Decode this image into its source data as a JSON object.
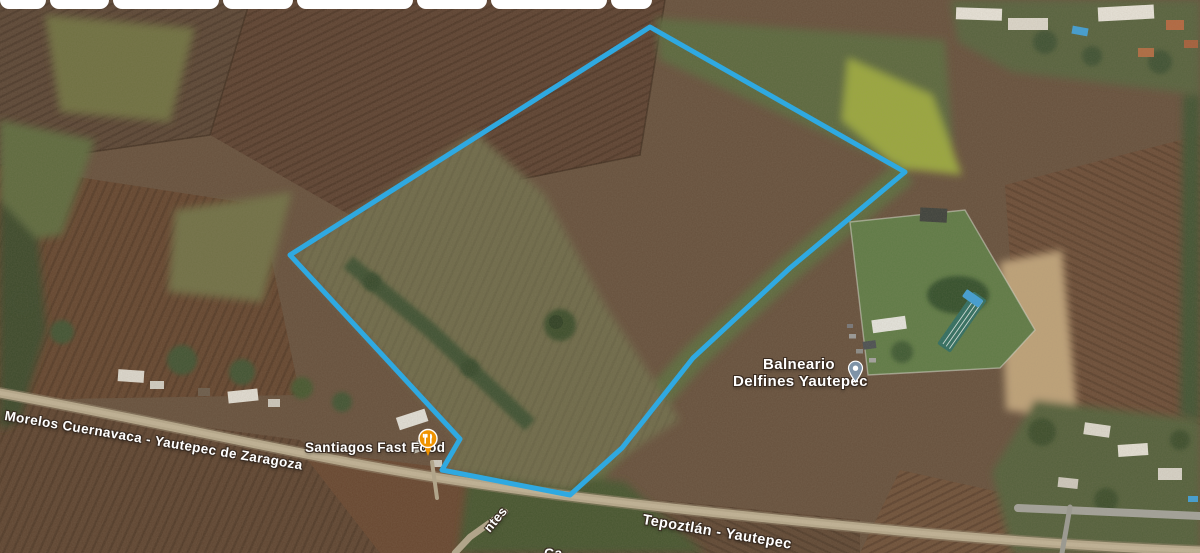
{
  "view": {
    "type": "satellite-map",
    "accent_color": "#2FA9E1"
  },
  "parcel_outline": {
    "color": "#2FA9E1",
    "stroke_width": 5,
    "points": "650,27 905,172 790,268 693,358 622,448 570,495 442,470 460,439 290,255"
  },
  "map_labels": {
    "road_primary": "Morelos Cuernavaca - Yautepec de Zaragoza",
    "road_secondary": "Tepoztlán - Yautepec",
    "street_fragment": "ntes",
    "partial_label_fragment": "Ca",
    "restaurant": {
      "name": "Santiagos Fast Food",
      "pin_color": "#F09300",
      "icon": "restaurant-pin"
    },
    "balneario": {
      "line1": "Balneario",
      "line2": "Delfines Yautepec",
      "pin_color": "#7E93A7",
      "icon": "place-pin"
    }
  },
  "top_chips": {
    "count": 8
  }
}
